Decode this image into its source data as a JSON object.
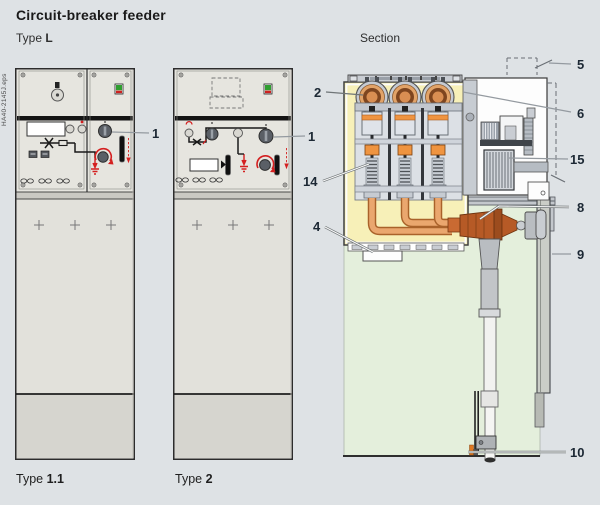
{
  "header": {
    "title": "Circuit-breaker feeder",
    "type_l_prefix": "Type",
    "type_l_bold": "L",
    "section_label": "Section",
    "watermark": "HA40-2145J.eps"
  },
  "footer": {
    "type11_prefix": "Type",
    "type11_bold": "1.1",
    "type2_prefix": "Type",
    "type2_bold": "2"
  },
  "callouts": {
    "front_left_actuator": "1",
    "front_middle_actuator": "1",
    "busbar_bushings": "2",
    "vessel_bottom": "4",
    "lv_compartment": "5",
    "enclosure_corner": "6",
    "cable_termination": "8",
    "cover": "9",
    "cable": "10",
    "pole_assembly": "14",
    "operating_mechanism": "15"
  },
  "colors": {
    "background": "#dee2e5",
    "panel_face": "#e6e5df",
    "vessel_yellow": "#f7f0b8",
    "cable_compartment_green": "#e4efdc",
    "copper": "#eaa76e",
    "copper_dark": "#b65a26",
    "indicator_green": "#2f9e2f",
    "accent_red": "#d42020",
    "callout_text": "#1c2834"
  }
}
